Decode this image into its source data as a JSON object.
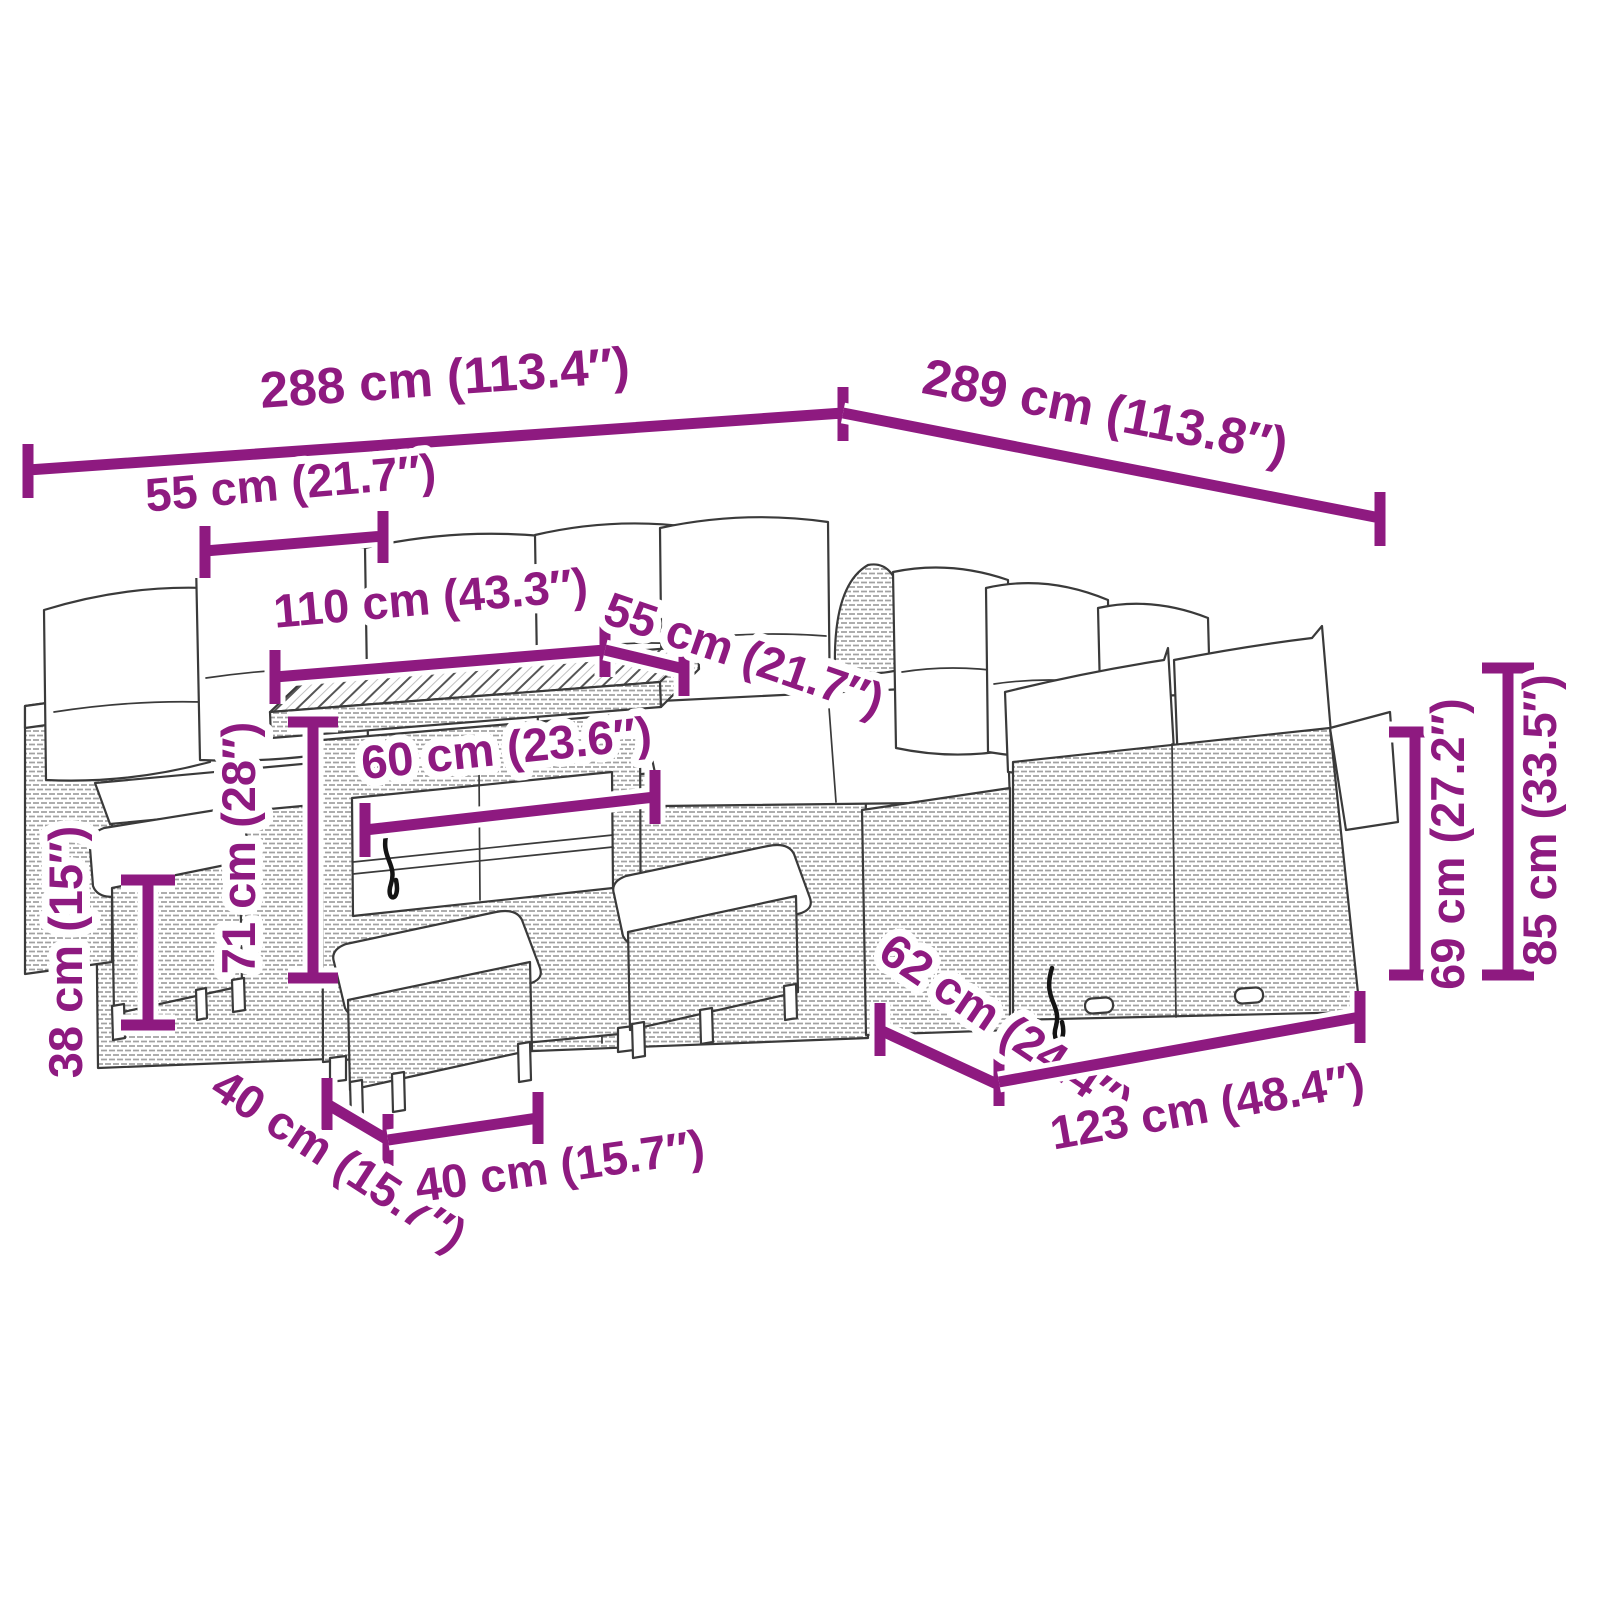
{
  "colors": {
    "accent": "#8e1a80",
    "line_art": "#3a3a3a",
    "background": "#ffffff"
  },
  "dimensions": [
    {
      "id": "back-width-left",
      "label": "288 cm (113.4″)"
    },
    {
      "id": "back-width-right",
      "label": "289 cm (113.8″)"
    },
    {
      "id": "seat-module-width",
      "label": "55 cm (21.7″)"
    },
    {
      "id": "table-length",
      "label": "110 cm (43.3″)"
    },
    {
      "id": "seat-depth",
      "label": "55 cm (21.7″)"
    },
    {
      "id": "table-width",
      "label": "60 cm (23.6″)"
    },
    {
      "id": "table-height",
      "label": "71 cm (28″)"
    },
    {
      "id": "stool-height",
      "label": "38 cm (15″)"
    },
    {
      "id": "stool-depth",
      "label": "40 cm (15.7″)"
    },
    {
      "id": "stool-width",
      "label": "40 cm (15.7″)"
    },
    {
      "id": "bench-depth",
      "label": "62 cm (24.4″)"
    },
    {
      "id": "bench-width",
      "label": "123 cm (48.4″)"
    },
    {
      "id": "backrest-height",
      "label": "69 cm (27.2″)"
    },
    {
      "id": "total-height",
      "label": "85 cm (33.5″)"
    }
  ]
}
